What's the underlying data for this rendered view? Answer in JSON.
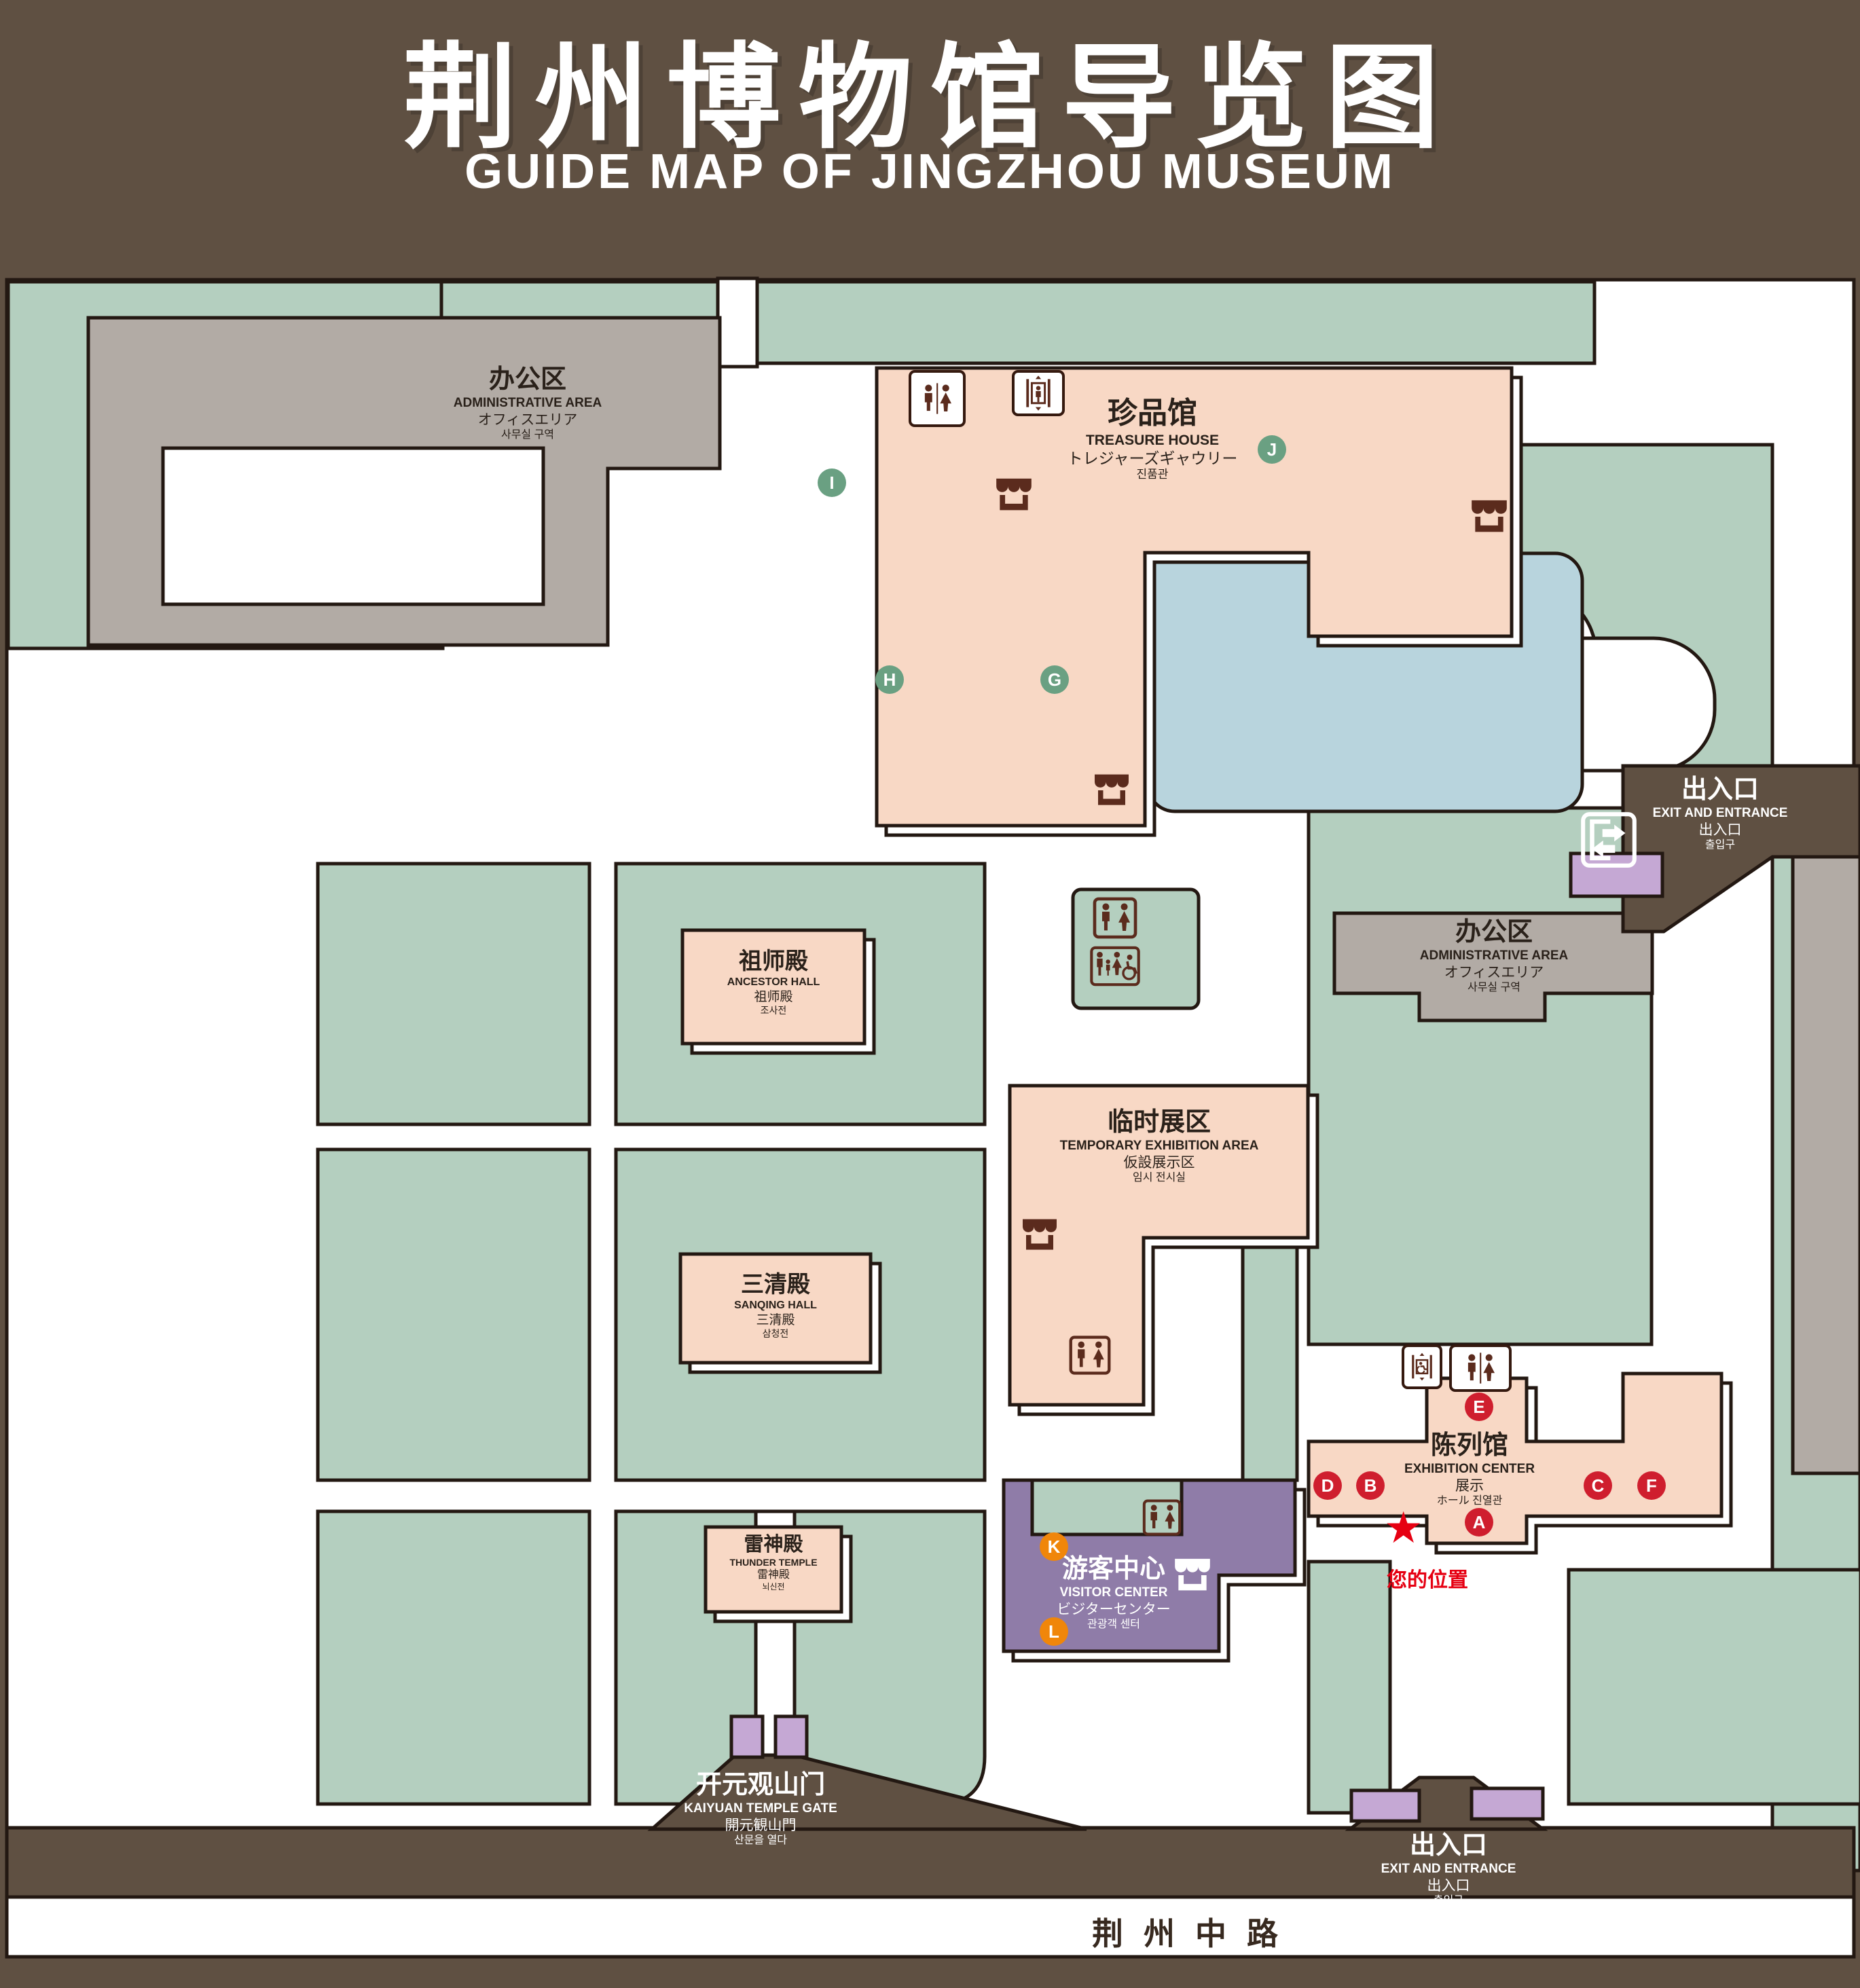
{
  "title": {
    "zh": "荆州博物馆导览图",
    "en": "GUIDE MAP OF JINGZHOU MUSEUM"
  },
  "colors": {
    "background": "#5f5042",
    "green": "#b4cfbf",
    "display_area": "#f8d8c5",
    "office_area": "#b2aba5",
    "pond": "#b8d4dd",
    "visitor_center": "#8f7ca8",
    "gate_purple": "#c5a8d4",
    "badge_red": "#cf1e2e",
    "badge_green": "#6aa082",
    "badge_orange": "#f0860a",
    "icon_brown": "#5b2b1d",
    "location_red": "#e60012",
    "outline": "#231812"
  },
  "icons": {
    "star": "★"
  },
  "legend": {
    "sections": [
      {
        "zh": "陈列馆",
        "en": "EXHIBITION CENTER",
        "items": [
          {
            "key": "A",
            "zh": "《火中的凤凰》壁画",
            "en": "THE PHOENIX IN FIRE \"MURAL PAINTING",
            "floor": "1F"
          },
          {
            "key": "B",
            "zh": "荆州出土铜器展",
            "en": "JINGZHOU UNEARTHED BRONZE WARE EXHIBITION",
            "floor": "1F"
          },
          {
            "key": "C",
            "zh": "江汉平原原始文化展",
            "en": "JIANGHAN PLAIN PRIMITIVE CULTURE EXHIBITION",
            "floor": "1F"
          },
          {
            "key": "D",
            "zh": "荆州出土瓷器展",
            "en": "JINGZHOU UNEARTHED PORCELAIN EXHIBITIONE",
            "floor": "2F"
          },
          {
            "key": "E",
            "zh": "荆州出土简牍展",
            "en": "JINGZHOU EXCAVATED BAMBOO SLIPS EXHIBITION",
            "floor": "2F"
          },
          {
            "key": "F",
            "zh": "荆州出土玉器展",
            "en": "JINGZHOU UNEARTHED JADE EXHIBITION",
            "floor": "2F"
          }
        ]
      },
      {
        "zh": "珍品馆",
        "en": "TREASURE HOUSE",
        "items": [
          {
            "key": "G",
            "zh": "放映厅",
            "en": "PROJECTION HALL",
            "floor": "1F"
          },
          {
            "key": "H",
            "zh": "互动体验厅",
            "en": "INTERACTIVE EXPERIENCE HALL",
            "floor": "1F"
          },
          {
            "key": "I",
            "zh": "五大夫遂——凤凰山168号汉墓展",
            "en": "WUDAFU—EXHIBITION OF NO.168 HAN TOMB FROM FENGHUANGSHAN",
            "floor": "2F"
          },
          {
            "key": "J",
            "zh": "丹漆神韵——楚秦汉漆器精品展",
            "en": "ROMANTIC CHARM OF THE CRIMSON LACQUERS—EXHIBITIONS",
            "en2": "OF FINE LACQUERS FROM CHU,QIN AND HAN DYNASTIES",
            "floor": "1-2F"
          }
        ]
      },
      {
        "zh": "游客中心",
        "en": "VISITOR CENTER",
        "items": [
          {
            "key": "K",
            "zh": "安全保卫",
            "en": "SECURITY",
            "floor": "1F"
          },
          {
            "key": "L",
            "zh": "医疗点",
            "en": "CLINIC",
            "floor": "1F"
          }
        ]
      }
    ],
    "symbols_left": [
      {
        "name": "store-icon",
        "zh": "文创商店",
        "en": "STORE"
      },
      {
        "name": "restrooms-icon",
        "zh": "卫生间",
        "en": "RESTROOMS"
      },
      {
        "name": "family-restrooms-icon",
        "zh": "家庭卫生间",
        "en": "FAMILY RESTROOMS"
      },
      {
        "name": "accessible-elevator-icon",
        "zh": "无障碍电梯",
        "en": "ACCESSIBLE ELEVATOR"
      },
      {
        "name": "elevator-icon",
        "zh": "电梯",
        "en": "Elevator"
      }
    ],
    "symbols_right": [
      {
        "name": "exit-entrance-icon",
        "zh": "出入口",
        "en": "EXIT AND ENTRANCE"
      },
      {
        "name": "your-location-icon",
        "zh": "您的位置",
        "en": "YOUR LOCATION"
      },
      {
        "name": "office-area-swatch",
        "zh": "办公区域",
        "en": "OFFICE AREA"
      },
      {
        "name": "display-area-swatch",
        "zh": "展示区域",
        "en": "DISPLAY AREA"
      }
    ]
  },
  "map": {
    "road": "荆州中路",
    "your_location": "您的位置",
    "buildings": {
      "admin": {
        "zh": "办公区",
        "en": "ADMINISTRATIVE AREA",
        "ja": "オフィスエリア",
        "ko": "사무실 구역"
      },
      "treasure_house": {
        "zh": "珍品馆",
        "en": "TREASURE HOUSE",
        "ja": "トレジャーズギャウリー",
        "ko": "진품관"
      },
      "ancestor_hall": {
        "zh": "祖师殿",
        "en": "ANCESTOR HALL",
        "ja": "祖师殿",
        "ko": "조사전"
      },
      "temporary_area": {
        "zh": "临时展区",
        "en": "TEMPORARY EXHIBITION AREA",
        "ja": "仮設展示区",
        "ko": "임시 전시실"
      },
      "sanqing_hall": {
        "zh": "三清殿",
        "en": "SANQING HALL",
        "ja": "三清殿",
        "ko": "삼청전"
      },
      "thunder_temple": {
        "zh": "雷神殿",
        "en": "THUNDER TEMPLE",
        "ja": "雷神殿",
        "ko": "뇌신전"
      },
      "visitor_center": {
        "zh": "游客中心",
        "en": "VISITOR CENTER",
        "ja": "ビジターセンター",
        "ko": "관광객 센터"
      },
      "exhibition_center": {
        "zh": "陈列馆",
        "en": "EXHIBITION CENTER",
        "ja": "展示",
        "ko": "ホール 진열관"
      },
      "gate": {
        "zh": "开元观山门",
        "en": "KAIYUAN TEMPLE GATE",
        "ja": "開元観山門",
        "ko": "산문을 열다"
      },
      "exit": {
        "zh": "出入口",
        "en": "EXIT AND ENTRANCE",
        "ja": "出入口",
        "ko": "출입구"
      }
    }
  }
}
